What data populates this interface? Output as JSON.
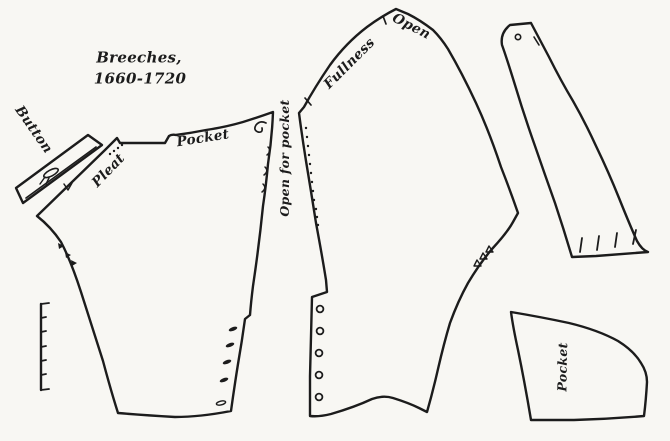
{
  "title": {
    "line1": "Breeches,",
    "line2": "1660-1720"
  },
  "labels": {
    "button": "Button",
    "pleat": "Pleat",
    "pocket_front": "Pocket",
    "open_for_pocket": "Open for pocket",
    "fullness": "Fullness",
    "open": "Open",
    "pocket_piece": "Pocket"
  },
  "colors": {
    "ink": "#1c1c1c",
    "paper": "#f8f7f3"
  },
  "marks": {
    "pleat_dots": 4,
    "front_side_notches": 3,
    "front_knee_buttons": 5,
    "back_seam_dots": 12,
    "back_knee_buttonholes": 5,
    "back_gather_notches": 3,
    "strap_bottom_notches": 4,
    "scale_bar_ticks": 7
  }
}
